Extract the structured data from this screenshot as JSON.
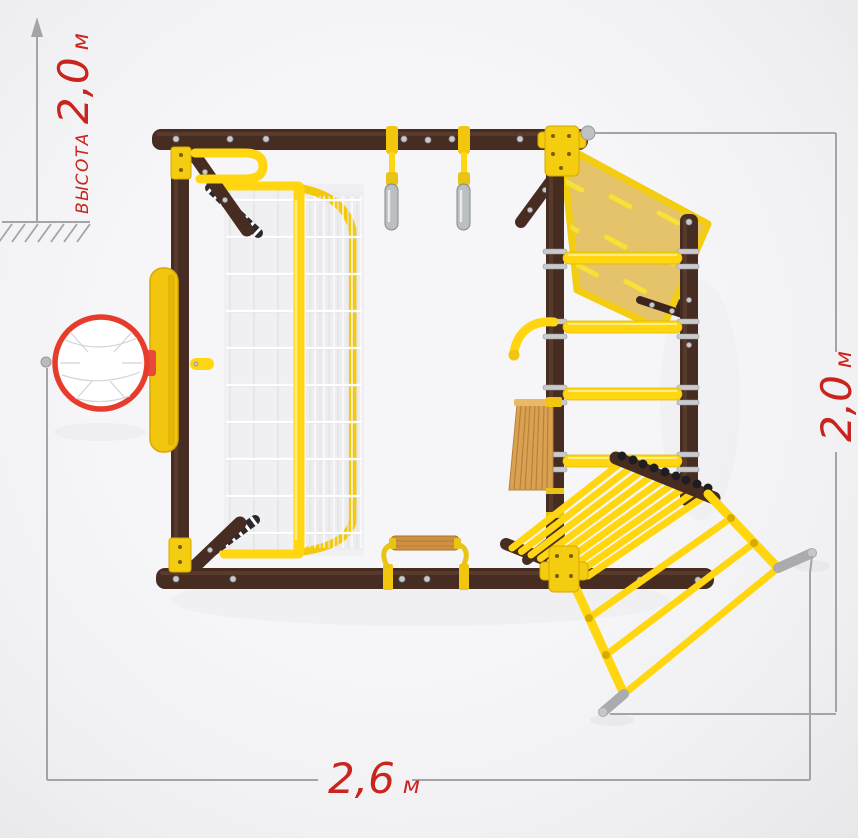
{
  "title": "playground-complex-top-view-diagram",
  "dimensions": {
    "height": {
      "word": "высота",
      "value": "2,0",
      "unit": "м",
      "meters": 2.0
    },
    "depth": {
      "value": "2,0",
      "unit": "м",
      "meters": 2.0
    },
    "width": {
      "value": "2,6",
      "unit": "м",
      "meters": 2.6
    }
  },
  "colors": {
    "background": "#f1f1f3",
    "frame_brown": "#462c21",
    "frame_brown_highlight": "#5d4030",
    "accent_yellow": "#ffd60f",
    "slide_yellow": "#e5c36a",
    "slide_dash_yellow": "#f6e134",
    "wood": "#daa152",
    "dimension_gray": "#a4a4a7",
    "label_red": "#c9241d",
    "hoop_red": "#e73c2c",
    "net_white": "#ffffff",
    "metal_gray": "#b9babd"
  },
  "components": [
    "top-beam",
    "bottom-beam",
    "left-post",
    "inner-post",
    "right-post",
    "basketball-backboard",
    "basketball-hoop",
    "climbing-net",
    "net-frame",
    "gymnastic-rings",
    "slide",
    "wall-bar-rungs",
    "climbing-board",
    "grip-handle",
    "rung-bridge",
    "exit-ladder",
    "ladder-feet",
    "swing-seat",
    "ground-hatch"
  ]
}
